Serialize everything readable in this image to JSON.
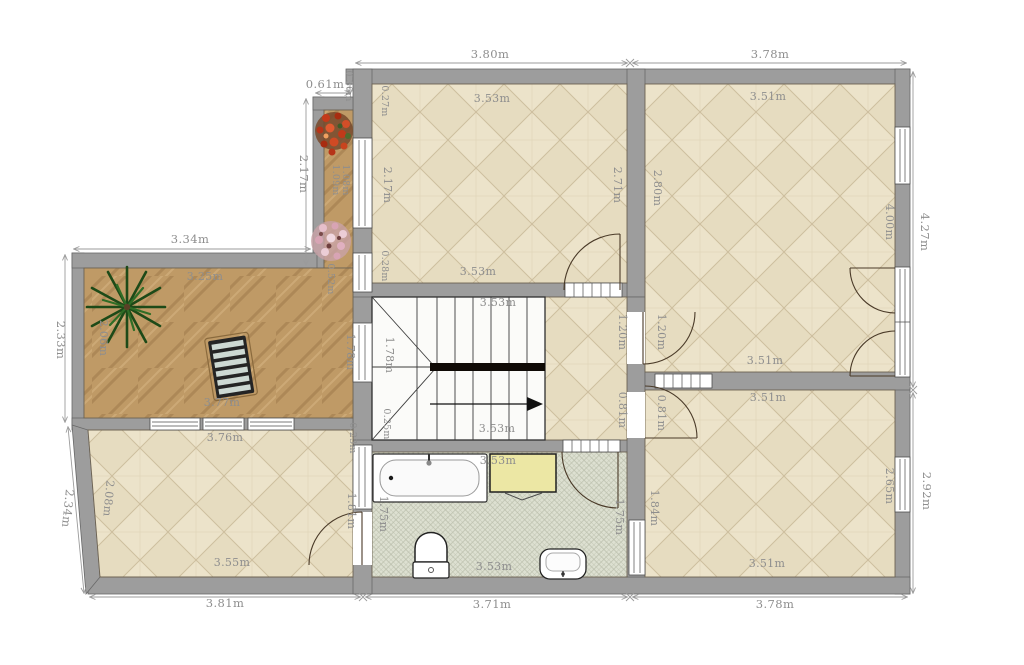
{
  "plan": {
    "type": "floor-plan",
    "unit": "m",
    "dims": {
      "balcony_top": "0.61m",
      "balcony_depth": "0.36m",
      "top_a": "3.80m",
      "top_b": "3.78m",
      "balcony_side": "2.17m",
      "terrace_top": "3.34m",
      "terrace_side": "2.33m",
      "slant_side": "2.34m",
      "bottom_a": "3.81m",
      "bottom_b": "3.71m",
      "bottom_c": "3.78m",
      "right_a": "4.27m",
      "right_b": "2.92m"
    },
    "rooms": {
      "top_mid": {
        "w_top": "3.53m",
        "h_left": "2.17m",
        "h_right": "2.71m",
        "w_bottom": "3.53m",
        "off_top": "0.27m",
        "off_bottom": "0.28m"
      },
      "top_right": {
        "w_top": "3.51m",
        "h_left": "2.80m",
        "h_right": "4.00m",
        "w_bottom": "3.51m"
      },
      "balcony": {
        "len_a": "1.09m",
        "len_b": "1.08m"
      },
      "terrace": {
        "w_top": "3.25m",
        "h_left": "2.06m",
        "w_bottom": "3.77m",
        "notch": "0.52m",
        "h_right": "1.78m"
      },
      "stairs": {
        "w_top": "3.53m",
        "h_left": "1.78m",
        "w_bottom": "3.53m",
        "off": "0.25m"
      },
      "hall": {
        "door_top_a": "1.20m",
        "door_top_b": "1.20m",
        "door_bottom_a": "0.81m",
        "door_bottom_b": "0.81m"
      },
      "bathroom": {
        "w_top": "3.53m",
        "h_left": "1.75m",
        "h_right": "1.75m",
        "w_bottom": "3.53m"
      },
      "bottom_left": {
        "w_top": "3.76m",
        "h_left": "2.08m",
        "w_bottom": "3.55m",
        "h_right": "1.81m",
        "off": "0.23m"
      },
      "bottom_right": {
        "w_top": "3.51m",
        "h_left": "1.84m",
        "h_right": "2.65m",
        "w_bottom": "3.51m"
      }
    },
    "objects": {
      "bathtub": "bathtub",
      "cabinet": "yellow-cabinet",
      "toilet": "toilet",
      "sink": "sink",
      "stairs": "u-shaped-stairs-with-direction-arrow",
      "palm": "palm-plant",
      "lounger": "sun-lounger",
      "flowers_red": "red-flower-box",
      "flowers_pink": "pink-flower-box"
    },
    "colors": {
      "wall": "#9d9d9d",
      "floor_beige": "#ebe2c9",
      "terrace_wood": "#bf9a66",
      "bathroom_tile": "#dde0d1",
      "cabinet_yellow": "#ece7a4",
      "dim_text": "#8e8e8e"
    }
  }
}
